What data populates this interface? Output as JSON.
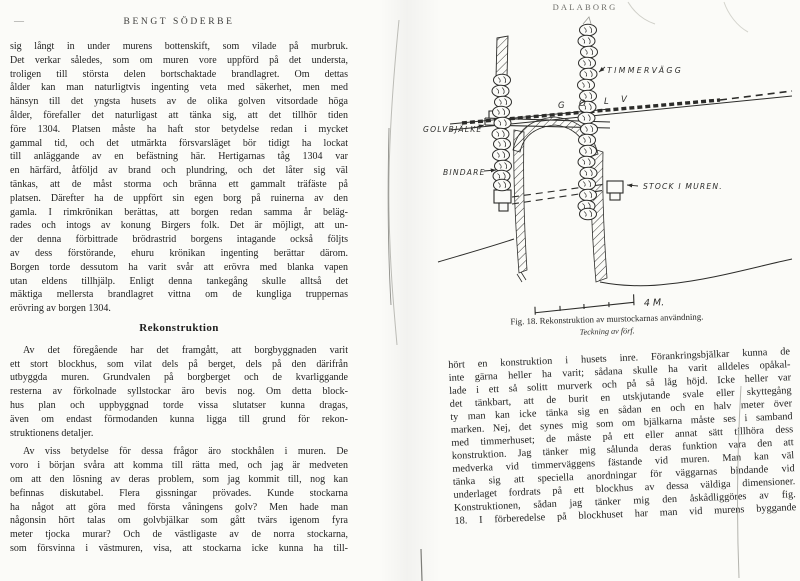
{
  "colors": {
    "paper": "#fbfbf8",
    "ink": "#1f1f1f"
  },
  "page_left": {
    "page_number_mark": "—",
    "running_header": "BENGT SÖDERBE",
    "para1_lines": [
      "sig långt in under murens bottenskift, som vilade på murbruk.",
      "Det verkar således, som om muren vore uppförd på det understa,",
      "troligen till största delen bortschaktade brandlagret. Om dettas",
      "ålder kan man naturligtvis ingenting veta med säkerhet, men med",
      "hänsyn till det yngsta husets av de olika golven vitsordade höga",
      "ålder, förefaller det naturligast att tänka sig, att det tillhör tiden",
      "före 1304. Platsen måste ha haft stor betydelse redan i mycket",
      "gammal tid, och det utmärkta försvarsläget bör tidigt ha lockat",
      "till anläggande av en befästning här. Hertigarnas tåg 1304 var",
      "en härfärd, åtföljd av brand och plundring, och det låter sig väl",
      "tänkas, att de måst storma och bränna ett gammalt träfäste på",
      "platsen. Därefter ha de uppfört sin egen borg på ruinerna av den",
      "gamla. I rimkrönikan berättas, att borgen redan samma år beläg-",
      "rades och intogs av konung Birgers folk. Det är möjligt, att un-",
      "der denna förbittrade brödrastrid borgens intagande också följts",
      "av dess förstörande, ehuru krönikan ingenting berättar därom.",
      "Borgen torde dessutom ha varit svår att erövra med blanka vapen",
      "utan eldens tillhjälp. Enligt denna tankegång skulle alltså det",
      "mäktiga mellersta brandlagret vittna om de kungliga truppernas",
      "erövring av borgen 1304."
    ],
    "heading": "Rekonstruktion",
    "para2_lines": [
      "Av det föregående har det framgått, att borgbyggnaden varit",
      "ett stort blockhus, som vilat dels på berget, dels på den därifrån",
      "utbyggda muren. Grundvalen på borgberget och de kvarliggande",
      "resterna av förkolnade syllstockar äro bevis nog. Om detta block-",
      "hus plan och uppbyggnad torde vissa slutatser kunna dragas,",
      "även om endast förmodanden kunna ligga till grund för rekon-",
      "struktionens detaljer."
    ],
    "para3_lines": [
      "Av viss betydelse för dessa frågor äro stockhålen i muren. De",
      "voro i början svåra att komma till rätta med, och jag är medveten",
      "om att den lösning av deras problem, som jag kommit till, nog kan",
      "befinnas diskutabel. Flera gissningar prövades. Kunde stockarna",
      "ha något att göra med första våningens golv? Men hade man",
      "någonsin hört talas om golvbjälkar som gått tvärs igenom fyra",
      "meter tjocka murar? Och de västligaste av de norra stockarna,",
      "som försvinna i västmuren, visa, att stockarna icke kunna ha till-"
    ]
  },
  "page_right": {
    "running_header": "DALABORG",
    "figure": {
      "labels": {
        "timmervagg": "TIMMERVÄGG",
        "golv_letters": [
          "G",
          "O",
          "L",
          "V"
        ],
        "golvbjalke": "GOLVBJÄLKE",
        "bindare": "BINDARE",
        "stock_i_muren": "STOCK I MUREN.",
        "scale": "4 M."
      },
      "caption_line1": "Fig. 18. Rekonstruktion av murstockarnas användning.",
      "caption_line2": "Teckning av förf."
    },
    "body_lines": [
      "hört en konstruktion i husets inre. Förankringsbjälkar kunna de",
      "inte gärna heller ha varit; sådana skulle ha varit alldeles opåkal-",
      "lade i ett så solitt murverk och på så låg höjd. Icke heller var",
      "det tänkbart, att de burit en utskjutande svale eller skyttegång",
      "ty man kan icke tänka sig en sådan en och en halv meter över",
      "marken. Nej, det synes mig som om bjälkarna måste ses i samband",
      "med timmerhuset; de måste på ett eller annat sätt tillhöra dess",
      "konstruktion. Jag tänker mig sålunda deras funktion vara den att",
      "medverka vid timmerväggens fästande vid muren. Man kan väl",
      "tänka sig att speciella anordningar för väggarnas bindande vid",
      "underlaget fordrats på ett blockhus av dessa väldiga dimensioner.",
      "Konstruktionen, sådan jag tänker mig den åskådliggöres av fig.",
      "18. I förberedelse på blockhuset har man vid murens byggande"
    ]
  }
}
